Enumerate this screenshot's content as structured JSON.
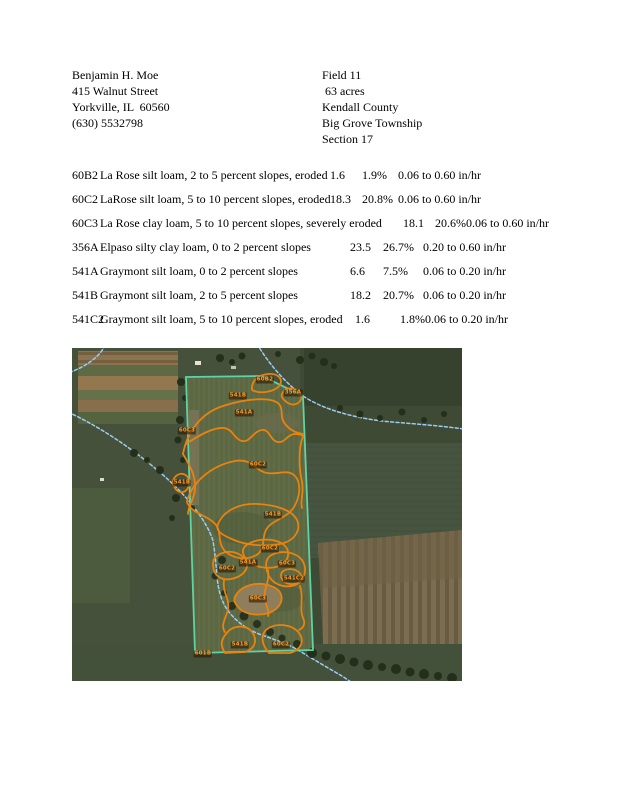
{
  "owner": {
    "name": "Benjamin H. Moe",
    "street": "415 Walnut Street",
    "city_line": "Yorkville, IL  60560",
    "phone": "(630) 5532798"
  },
  "field": {
    "name": "Field 11",
    "acres": " 63 acres",
    "county": "Kendall County",
    "township": "Big Grove Township",
    "section": "Section 17"
  },
  "soil_table": {
    "rows": [
      {
        "code": "60B2",
        "description": "La Rose silt loam, 2 to 5 percent slopes, eroded",
        "acres": "1.6",
        "percent": "1.9%",
        "infiltration": "0.06 to 0.60 in/hr"
      },
      {
        "code": "60C2",
        "description": "LaRose silt loam, 5 to 10 percent slopes, eroded",
        "acres": "18.3",
        "percent": "20.8%",
        "infiltration": "0.06 to 0.60 in/hr"
      },
      {
        "code": "60C3",
        "description": "La Rose clay loam, 5 to 10 percent slopes, severely eroded",
        "acres": "18.1",
        "percent": "20.6%",
        "infiltration": "0.06 to 0.60 in/hr"
      },
      {
        "code": "356A",
        "description": "Elpaso silty clay loam, 0 to 2 percent slopes",
        "acres": "23.5",
        "percent": "26.7%",
        "infiltration": "0.20 to 0.60 in/hr"
      },
      {
        "code": "541A",
        "description": "Graymont silt loam, 0 to 2 percent slopes",
        "acres": "6.6",
        "percent": "7.5%",
        "infiltration": "0.06 to 0.20 in/hr"
      },
      {
        "code": "541B",
        "description": "Graymont silt loam, 2 to 5 percent slopes",
        "acres": "18.2",
        "percent": "20.7%",
        "infiltration": "0.06 to 0.20 in/hr"
      },
      {
        "code": "541C2",
        "description": "Graymont silt loam, 5 to 10 percent slopes, eroded",
        "acres": "1.6",
        "percent": "1.8%",
        "infiltration": "0.06 to 0.20 in/hr"
      }
    ]
  },
  "map": {
    "labels": [
      {
        "code": "60B2",
        "x": 193,
        "y": 32
      },
      {
        "code": "356A",
        "x": 221,
        "y": 45
      },
      {
        "code": "541B",
        "x": 166,
        "y": 48
      },
      {
        "code": "541A",
        "x": 172,
        "y": 65
      },
      {
        "code": "60C3",
        "x": 115,
        "y": 83
      },
      {
        "code": "60C2",
        "x": 186,
        "y": 117
      },
      {
        "code": "541B",
        "x": 110,
        "y": 135
      },
      {
        "code": "541B",
        "x": 201,
        "y": 167
      },
      {
        "code": "60C2",
        "x": 198,
        "y": 201
      },
      {
        "code": "541A",
        "x": 176,
        "y": 215
      },
      {
        "code": "60C2",
        "x": 155,
        "y": 221
      },
      {
        "code": "60C3",
        "x": 215,
        "y": 216
      },
      {
        "code": "541C2",
        "x": 222,
        "y": 231
      },
      {
        "code": "60C3",
        "x": 186,
        "y": 251
      },
      {
        "code": "541B",
        "x": 168,
        "y": 297
      },
      {
        "code": "60C2",
        "x": 209,
        "y": 297
      },
      {
        "code": "601B",
        "x": 131,
        "y": 306
      }
    ],
    "colors": {
      "boundary": "#5fd3a2",
      "soil_outline": "#e8830d",
      "stream": "#9ccbf2",
      "label_text": "#ff9d1f"
    }
  }
}
